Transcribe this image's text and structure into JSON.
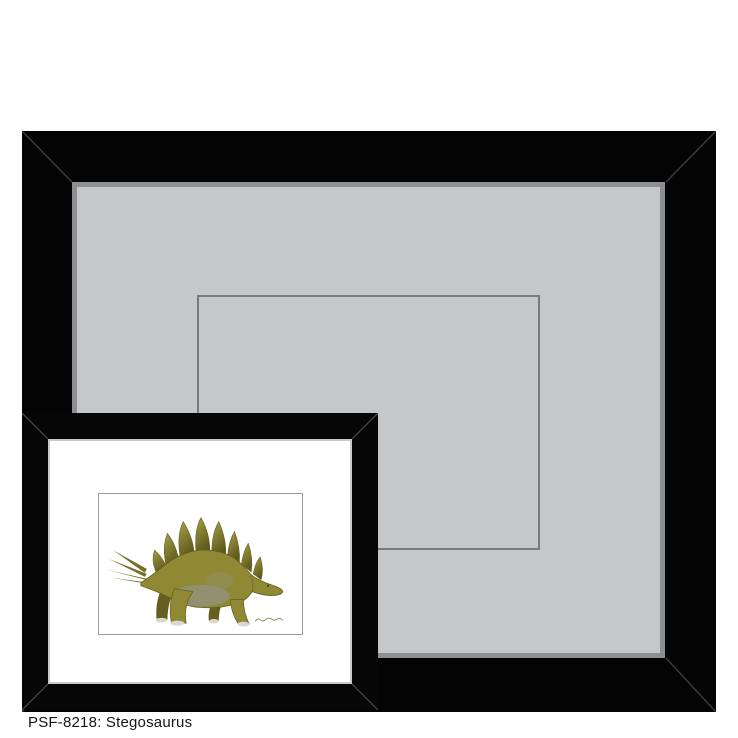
{
  "page": {
    "background": "#ffffff"
  },
  "caption": {
    "text": "PSF-8218: Stegosaurus",
    "sku": "PSF-8218",
    "subject": "Stegosaurus"
  },
  "large_frame": {
    "description": "wide black frame with gray mat and empty inner mat opening",
    "colors": {
      "frame": "#040404",
      "mat": "#c6c7c9",
      "bevel": "#8d8e91",
      "opening_line": "#77797c",
      "miter_line": "#3d3d3d"
    }
  },
  "small_frame": {
    "description": "black frame, white mat, stegosaurus print",
    "colors": {
      "frame": "#060606",
      "mat": "#ffffff",
      "fillet": "#c9c9c9",
      "art_border": "#9a9a9a",
      "miter_line": "#4a4a4a"
    }
  },
  "stegosaurus": {
    "colors": {
      "body": "#8f8933",
      "shade": "#645f1f",
      "plate_dark": "#5f5a1e",
      "plate_light": "#a8a047",
      "spike": "#767026",
      "belly": "#94907d",
      "foot": "#d9d9d1",
      "eye": "#3a3a20",
      "signature": "#8b8547"
    }
  }
}
